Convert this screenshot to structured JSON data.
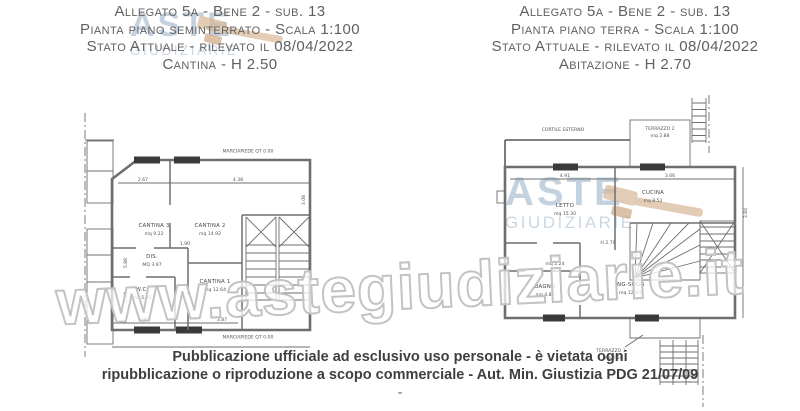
{
  "page": {
    "watermark_text": "www.astegiudiziarie.it",
    "publication_notice_line1": "Pubblicazione ufficiale ad esclusivo uso personale - è vietata ogni",
    "publication_notice_line2": "ripubblicazione o riproduzione a scopo commerciale - Aut. Min. Giustizia PDG 21/07/09",
    "publication_notice_line3": "-",
    "colors": {
      "drawing_line": "#6e6e6e",
      "header_text": "#606060",
      "logo_blue": "#a0b7cb",
      "gavel_tan": "#d8b796",
      "watermark_outline": "#c3c3c3"
    }
  },
  "logo": {
    "line1": "ASTE",
    "line2": "GIUDIZIARIE"
  },
  "left_sheet": {
    "header": [
      "Allegato 5a - Bene 2 - sub. 13",
      "Pianta piano seminterrato - Scala 1:100",
      "Stato Attuale - rilevato il 08/04/2022",
      "Cantina - H 2.50"
    ],
    "plan": {
      "sidewalk_top": "MARCIAPIEDE QT 0.00",
      "sidewalk_bottom": "MARCIAPIEDE QT 0.00",
      "rooms": {
        "cantina3": {
          "name": "CANTINA 3",
          "area": "mq 9.22"
        },
        "cantina2": {
          "name": "CANTINA 2",
          "area": "mq 14.92"
        },
        "dis": {
          "name": "DIS.",
          "area": "MQ 3.97"
        },
        "wc": {
          "name": "W.C.",
          "area": "mq 5.92"
        },
        "cantina1": {
          "name": "CANTINA 1",
          "area": "mq 12.64"
        }
      },
      "dims": {
        "top1": "2.67",
        "top2": "4.38",
        "right": "3.08",
        "left1": "5.88",
        "left2": "5.00",
        "mid": "1.90",
        "bottom1": "2.87",
        "bottom2": "3.87"
      }
    }
  },
  "right_sheet": {
    "header": [
      "Allegato 5a - Bene 2 - sub. 13",
      "Pianta piano terra - Scala 1:100",
      "Stato Attuale - rilevato il 08/04/2022",
      "Abitazione - H 2.70"
    ],
    "plan": {
      "height_note": "H 2.70",
      "rooms": {
        "cortile": {
          "name": "CORTILE ESTERNO",
          "area": ""
        },
        "terrazzo2": {
          "name": "TERRAZZO 2",
          "area": "mq 2.88"
        },
        "letto": {
          "name": "LETTO",
          "area": "mq 15.30"
        },
        "cucina": {
          "name": "CUCINA",
          "area": "mq 8.52"
        },
        "ab": {
          "name": "A.B.",
          "area": "mq 2.24"
        },
        "bagno": {
          "name": "BAGNO",
          "area": "mq 4.87"
        },
        "ingsogg": {
          "name": "ING-SOGG",
          "area": "mq 12.90"
        },
        "terrazzo1": {
          "name": "TERRAZZO 1",
          "area": "mq 2.54"
        }
      },
      "dims": {
        "top1": "4.91",
        "top2": "3.66",
        "right": "3.84"
      }
    }
  }
}
